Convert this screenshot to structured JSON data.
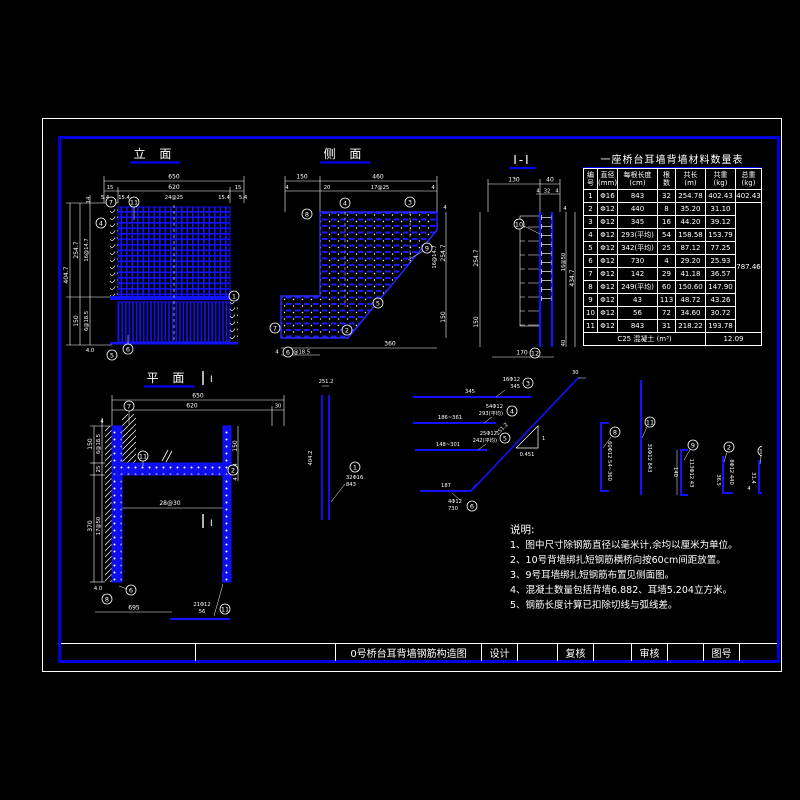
{
  "colors": {
    "blue": "#0000ff",
    "frame_blue": "#0000dd",
    "white": "#ffffff",
    "background": "#000000"
  },
  "titlebar": {
    "title": "0号桥台耳背墙钢筋构造图",
    "design": "设计",
    "review": "复核",
    "audit": "审核",
    "figno": "图号"
  },
  "table": {
    "title": "一座桥台耳墙背墙材料数量表",
    "headers": [
      "编\n号",
      "直径\n(mm)",
      "每根长度\n(cm)",
      "根\n数",
      "共长\n(m)",
      "共重\n(kg)",
      "总重\n(kg)"
    ],
    "rows": [
      [
        "1",
        "Φ16",
        "843",
        "32",
        "254.78",
        "402.43"
      ],
      [
        "2",
        "Φ12",
        "440",
        "8",
        "35.20",
        "31.10"
      ],
      [
        "3",
        "Φ12",
        "345",
        "16",
        "44.20",
        "39.12"
      ],
      [
        "4",
        "Φ12",
        "293(平均)",
        "54",
        "158.58",
        "153.79"
      ],
      [
        "5",
        "Φ12",
        "342(平均)",
        "25",
        "87.12",
        "77.25"
      ],
      [
        "6",
        "Φ12",
        "730",
        "4",
        "29.20",
        "25.93"
      ],
      [
        "7",
        "Φ12",
        "142",
        "29",
        "41.18",
        "36.57"
      ],
      [
        "8",
        "Φ12",
        "249(平均)",
        "60",
        "150.60",
        "147.90"
      ],
      [
        "9",
        "Φ12",
        "43",
        "113",
        "48.72",
        "43.26"
      ],
      [
        "10",
        "Φ12",
        "56",
        "72",
        "34.60",
        "30.72"
      ],
      [
        "11",
        "Φ12",
        "843",
        "31",
        "218.22",
        "193.78"
      ]
    ],
    "totals": {
      "first": "402.43",
      "rest": "787.46"
    },
    "footer_label": "C25 混凝土 (m³)",
    "footer_value": "12.09"
  },
  "elevation": {
    "title": "立 面",
    "dims": {
      "d650": "650",
      "d15l": "15",
      "d620": "620",
      "d15r": "15",
      "s1": "5.4",
      "s2": "15.4",
      "s3": "24@25",
      "s4": "15.4",
      "s5": "5.4",
      "d14": "14",
      "d4047": "404.7",
      "d2547": "254.7",
      "d16147": "16@14.7",
      "d150": "150",
      "d6185": "6@18.5",
      "d40": "4.0"
    },
    "refs": {
      "r7": "7",
      "r11": "11",
      "r4": "4",
      "r1": "1",
      "r6": "6",
      "r5": "5"
    }
  },
  "side": {
    "title": "侧 面",
    "dims": {
      "d150": "150",
      "d460": "460",
      "d4a": "4",
      "d20": "20",
      "d1725": "17@25",
      "d4b": "4",
      "d4r": "4",
      "d2547": "254.7",
      "d16147": "16@14.7",
      "d150r": "150",
      "d360": "360",
      "d6185": "6@18.5",
      "d4c": "4"
    },
    "refs": {
      "r8": "8",
      "r4": "4",
      "r3": "3",
      "r9": "9",
      "r5": "5",
      "r2": "2",
      "r7": "7",
      "r6": "6"
    }
  },
  "section": {
    "title": "I-I",
    "dims": {
      "d130": "130",
      "d40": "40",
      "s4a": "4",
      "s32": "32",
      "s4b": "4",
      "d2547": "254.7",
      "d150": "150",
      "d1650": "16@50",
      "d4347": "434.7",
      "d4": "4",
      "d40b": "40",
      "d170": "170"
    },
    "refs": {
      "r10": "10",
      "r12": "12"
    }
  },
  "plan": {
    "title": "平 面",
    "marker": "I",
    "dims": {
      "d650": "650",
      "d620": "620",
      "d30": "30",
      "d150": "150",
      "d6185": "6@18.5",
      "d25": "25",
      "d370": "370",
      "d1750": "17@50",
      "d4": "4",
      "d40": "4.0",
      "d150r": "150",
      "d254": "25.4",
      "d4r": "4",
      "d2830": "28@30",
      "d695": "695"
    },
    "refs": {
      "r7": "7",
      "r11": "11",
      "r2": "2",
      "r6": "6",
      "r8": "8"
    },
    "bar": {
      "l1": "21Φ12",
      "l2": "56"
    }
  },
  "details": {
    "vbar": {
      "top": "251.2",
      "left": "404.2",
      "ref": "1",
      "l1": "32Φ16",
      "l2": "843"
    },
    "bar3": {
      "dim": "345",
      "ref": "3",
      "l1": "16Φ12",
      "l2": "345"
    },
    "bar4": {
      "dim": "186~361",
      "ref": "4",
      "l1": "54Φ12",
      "l2": "293(平均)"
    },
    "bar5": {
      "dim": "148~301",
      "ref": "5",
      "l1": "25Φ12",
      "l2": "242(平均)"
    },
    "bar6": {
      "dim": "187",
      "ref": "6",
      "l1": "4Φ12",
      "l2": "730"
    },
    "diag": {
      "len": "251.2",
      "rise": "1",
      "run": "0.451",
      "corner": "30"
    },
    "d1": {
      "ref": "8",
      "label": "60Φ12 54~360"
    },
    "d2": {
      "ref": "11",
      "label": "31Φ12 843"
    },
    "d3": {
      "ref": "9",
      "label": "113Φ12 43",
      "dim": "140"
    },
    "d4": {
      "ref": "2",
      "label": "8Φ12 440",
      "dim": "36.5"
    },
    "d5": {
      "ref": "10",
      "label": "72Φ12 56",
      "dim": "31.4",
      "dim2": "4"
    }
  },
  "notes": {
    "title": "说明:",
    "items": [
      "1、图中尺寸除钢筋直径以毫米计,余均以厘米为单位。",
      "2、10号背墙绑扎短钢筋横桥向按60cm间距放置。",
      "3、9号耳墙绑扎短钢筋布置见侧面图。",
      "4、混凝土数量包括背墙6.882、耳墙5.204立方米。",
      "5、钢筋长度计算已扣除切线与弧线差。"
    ]
  }
}
